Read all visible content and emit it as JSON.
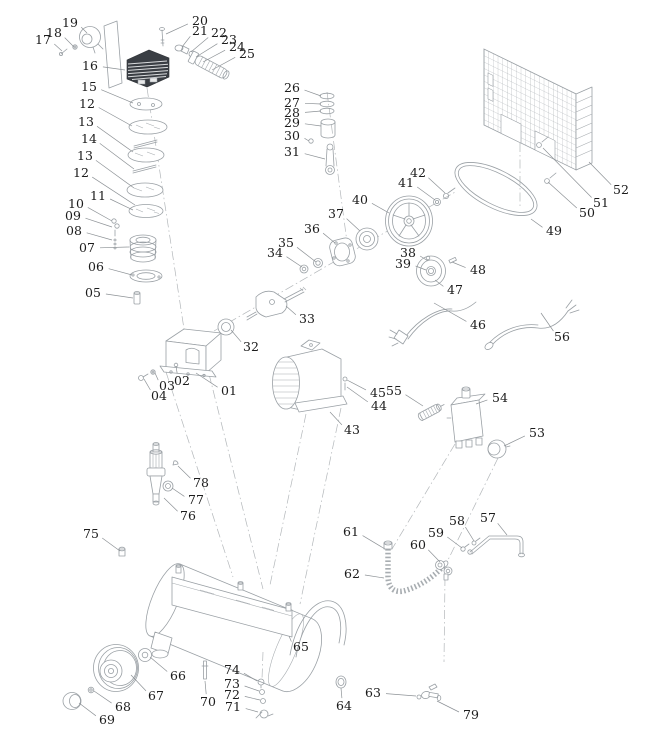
{
  "figure": {
    "description": "Air compressor exploded parts diagram",
    "canvas": {
      "width": 649,
      "height": 755
    },
    "colors": {
      "background": "#ffffff",
      "line": "#9aa0a5",
      "label": "#1c1c1c",
      "dark_part": "#3a3e44"
    },
    "callouts": [
      {
        "label": "01",
        "x": 229,
        "y": 391,
        "tx": 196,
        "ty": 373
      },
      {
        "label": "02",
        "x": 182,
        "y": 381,
        "tx": 176,
        "ty": 366
      },
      {
        "label": "03",
        "x": 167,
        "y": 386,
        "tx": 155,
        "ty": 373
      },
      {
        "label": "04",
        "x": 159,
        "y": 396,
        "tx": 144,
        "ty": 379
      },
      {
        "label": "05",
        "x": 93,
        "y": 293,
        "tx": 133,
        "ty": 298
      },
      {
        "label": "06",
        "x": 96,
        "y": 267,
        "tx": 132,
        "ty": 275
      },
      {
        "label": "07",
        "x": 87,
        "y": 248,
        "tx": 129,
        "ty": 247
      },
      {
        "label": "08",
        "x": 74,
        "y": 231,
        "tx": 112,
        "ty": 240
      },
      {
        "label": "09",
        "x": 73,
        "y": 216,
        "tx": 112,
        "ty": 227
      },
      {
        "label": "10",
        "x": 76,
        "y": 204,
        "tx": 112,
        "ty": 221
      },
      {
        "label": "11",
        "x": 98,
        "y": 196,
        "tx": 133,
        "ty": 210
      },
      {
        "label": "12",
        "x": 87,
        "y": 104,
        "tx": 132,
        "ty": 126
      },
      {
        "label": "13",
        "x": 86,
        "y": 122,
        "tx": 133,
        "ty": 152
      },
      {
        "label": "14",
        "x": 89,
        "y": 139,
        "tx": 134,
        "ty": 169
      },
      {
        "label": "13",
        "x": 85,
        "y": 156,
        "tx": 134,
        "ty": 188
      },
      {
        "label": "12",
        "x": 81,
        "y": 173,
        "tx": 135,
        "ty": 205
      },
      {
        "label": "15",
        "x": 89,
        "y": 87,
        "tx": 133,
        "ty": 103
      },
      {
        "label": "16",
        "x": 90,
        "y": 66,
        "tx": 125,
        "ty": 70
      },
      {
        "label": "17",
        "x": 43,
        "y": 40,
        "tx": 62,
        "ty": 51
      },
      {
        "label": "18",
        "x": 54,
        "y": 33,
        "tx": 74,
        "ty": 47
      },
      {
        "label": "19",
        "x": 70,
        "y": 23,
        "tx": 87,
        "ty": 33
      },
      {
        "label": "20",
        "x": 200,
        "y": 21,
        "tx": 166,
        "ty": 34
      },
      {
        "label": "21",
        "x": 200,
        "y": 31,
        "tx": 182,
        "ty": 47
      },
      {
        "label": "22",
        "x": 219,
        "y": 33,
        "tx": 191,
        "ty": 52
      },
      {
        "label": "23",
        "x": 229,
        "y": 40,
        "tx": 196,
        "ty": 57
      },
      {
        "label": "24",
        "x": 237,
        "y": 47,
        "tx": 203,
        "ty": 62
      },
      {
        "label": "25",
        "x": 247,
        "y": 54,
        "tx": 212,
        "ty": 70
      },
      {
        "label": "26",
        "x": 292,
        "y": 88,
        "tx": 321,
        "ty": 96
      },
      {
        "label": "27",
        "x": 292,
        "y": 103,
        "tx": 321,
        "ty": 104
      },
      {
        "label": "28",
        "x": 292,
        "y": 113,
        "tx": 321,
        "ty": 111
      },
      {
        "label": "29",
        "x": 292,
        "y": 123,
        "tx": 321,
        "ty": 126
      },
      {
        "label": "30",
        "x": 292,
        "y": 136,
        "tx": 309,
        "ty": 141
      },
      {
        "label": "31",
        "x": 292,
        "y": 152,
        "tx": 325,
        "ty": 159
      },
      {
        "label": "32",
        "x": 251,
        "y": 347,
        "tx": 231,
        "ty": 330
      },
      {
        "label": "33",
        "x": 307,
        "y": 319,
        "tx": 286,
        "ty": 306
      },
      {
        "label": "34",
        "x": 275,
        "y": 253,
        "tx": 302,
        "ty": 267
      },
      {
        "label": "35",
        "x": 286,
        "y": 243,
        "tx": 316,
        "ty": 262
      },
      {
        "label": "36",
        "x": 312,
        "y": 229,
        "tx": 335,
        "ty": 243
      },
      {
        "label": "37",
        "x": 336,
        "y": 214,
        "tx": 360,
        "ty": 231
      },
      {
        "label": "38",
        "x": 408,
        "y": 253,
        "tx": 428,
        "ty": 261
      },
      {
        "label": "39",
        "x": 403,
        "y": 264,
        "tx": 426,
        "ty": 270
      },
      {
        "label": "40",
        "x": 360,
        "y": 200,
        "tx": 389,
        "ty": 213
      },
      {
        "label": "41",
        "x": 406,
        "y": 183,
        "tx": 435,
        "ty": 200
      },
      {
        "label": "42",
        "x": 418,
        "y": 173,
        "tx": 445,
        "ty": 193
      },
      {
        "label": "43",
        "x": 352,
        "y": 430,
        "tx": 330,
        "ty": 412
      },
      {
        "label": "44",
        "x": 379,
        "y": 406,
        "tx": 347,
        "ty": 387
      },
      {
        "label": "45",
        "x": 378,
        "y": 393,
        "tx": 347,
        "ty": 380
      },
      {
        "label": "46",
        "x": 478,
        "y": 325,
        "tx": 434,
        "ty": 303
      },
      {
        "label": "47",
        "x": 455,
        "y": 290,
        "tx": 435,
        "ty": 280
      },
      {
        "label": "48",
        "x": 478,
        "y": 270,
        "tx": 452,
        "ty": 262
      },
      {
        "label": "49",
        "x": 554,
        "y": 231,
        "tx": 531,
        "ty": 219
      },
      {
        "label": "50",
        "x": 587,
        "y": 213,
        "tx": 548,
        "ty": 182
      },
      {
        "label": "51",
        "x": 601,
        "y": 203,
        "tx": 543,
        "ty": 148
      },
      {
        "label": "52",
        "x": 621,
        "y": 190,
        "tx": 589,
        "ty": 162
      },
      {
        "label": "53",
        "x": 537,
        "y": 433,
        "tx": 504,
        "ty": 446
      },
      {
        "label": "54",
        "x": 500,
        "y": 398,
        "tx": 476,
        "ty": 404
      },
      {
        "label": "55",
        "x": 394,
        "y": 391,
        "tx": 423,
        "ty": 406
      },
      {
        "label": "56",
        "x": 562,
        "y": 337,
        "tx": 541,
        "ty": 313
      },
      {
        "label": "57",
        "x": 488,
        "y": 518,
        "tx": 507,
        "ty": 535
      },
      {
        "label": "58",
        "x": 457,
        "y": 521,
        "tx": 474,
        "ty": 541
      },
      {
        "label": "59",
        "x": 436,
        "y": 533,
        "tx": 462,
        "ty": 548
      },
      {
        "label": "60",
        "x": 418,
        "y": 545,
        "tx": 440,
        "ty": 562
      },
      {
        "label": "61",
        "x": 351,
        "y": 532,
        "tx": 385,
        "ty": 549
      },
      {
        "label": "62",
        "x": 352,
        "y": 574,
        "tx": 384,
        "ty": 578
      },
      {
        "label": "63",
        "x": 373,
        "y": 693,
        "tx": 416,
        "ty": 696
      },
      {
        "label": "64",
        "x": 344,
        "y": 706,
        "tx": 341,
        "ty": 688
      },
      {
        "label": "65",
        "x": 301,
        "y": 647,
        "tx": 289,
        "ty": 636
      },
      {
        "label": "66",
        "x": 178,
        "y": 676,
        "tx": 150,
        "ty": 657
      },
      {
        "label": "67",
        "x": 156,
        "y": 696,
        "tx": 131,
        "ty": 675
      },
      {
        "label": "68",
        "x": 123,
        "y": 707,
        "tx": 94,
        "ty": 691
      },
      {
        "label": "69",
        "x": 107,
        "y": 720,
        "tx": 79,
        "ty": 703
      },
      {
        "label": "70",
        "x": 208,
        "y": 702,
        "tx": 205,
        "ty": 681
      },
      {
        "label": "71",
        "x": 233,
        "y": 707,
        "tx": 258,
        "ty": 712
      },
      {
        "label": "72",
        "x": 232,
        "y": 695,
        "tx": 260,
        "ty": 700
      },
      {
        "label": "73",
        "x": 232,
        "y": 684,
        "tx": 259,
        "ty": 691
      },
      {
        "label": "74",
        "x": 232,
        "y": 670,
        "tx": 257,
        "ty": 681
      },
      {
        "label": "75",
        "x": 91,
        "y": 534,
        "tx": 120,
        "ty": 551
      },
      {
        "label": "76",
        "x": 188,
        "y": 516,
        "tx": 164,
        "ty": 498
      },
      {
        "label": "77",
        "x": 196,
        "y": 500,
        "tx": 172,
        "ty": 488
      },
      {
        "label": "78",
        "x": 201,
        "y": 483,
        "tx": 178,
        "ty": 466
      },
      {
        "label": "79",
        "x": 471,
        "y": 715,
        "tx": 437,
        "ty": 701
      }
    ]
  }
}
